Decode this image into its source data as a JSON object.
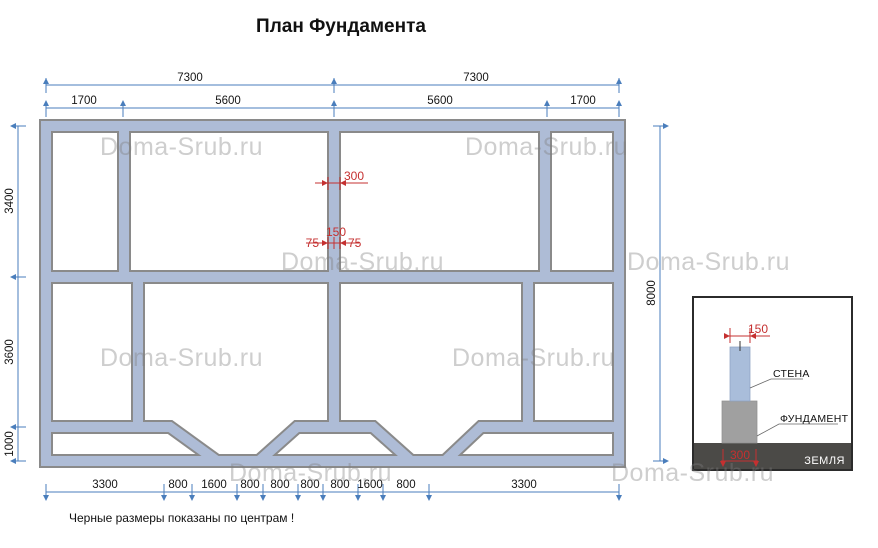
{
  "title": "План Фундамента",
  "footnote": "Черные размеры показаны по центрам !",
  "watermark_text": "Doma-Srub.ru",
  "colors": {
    "dim_line": "#4a7ebc",
    "dim_red": "#c53030",
    "wall_fill": "#aebcd6",
    "wall_outline": "#8a8a8a",
    "detail_wall_fill": "#a9bdda",
    "detail_foundation_fill": "#a0a0a0",
    "detail_ground_fill": "#4b4a47"
  },
  "plan": {
    "dims_top_overall": [
      "7300",
      "7300"
    ],
    "dims_top_segments": [
      "1700",
      "5600",
      "5600",
      "1700"
    ],
    "dims_left": [
      "3400",
      "3600",
      "1000"
    ],
    "dims_right": [
      "8000"
    ],
    "dims_bottom": [
      "3300",
      "800",
      "1600",
      "800",
      "800",
      "800",
      "800",
      "1600",
      "800",
      "3300"
    ],
    "dims_red": {
      "foundation_width": "300",
      "wall_width": "150",
      "offset_left": "75",
      "offset_right": "75"
    }
  },
  "detail": {
    "wall_label": "СТЕНА",
    "foundation_label": "ФУНДАМЕНТ",
    "ground_label": "ЗЕМЛЯ",
    "wall_width": "150",
    "foundation_width": "300"
  }
}
